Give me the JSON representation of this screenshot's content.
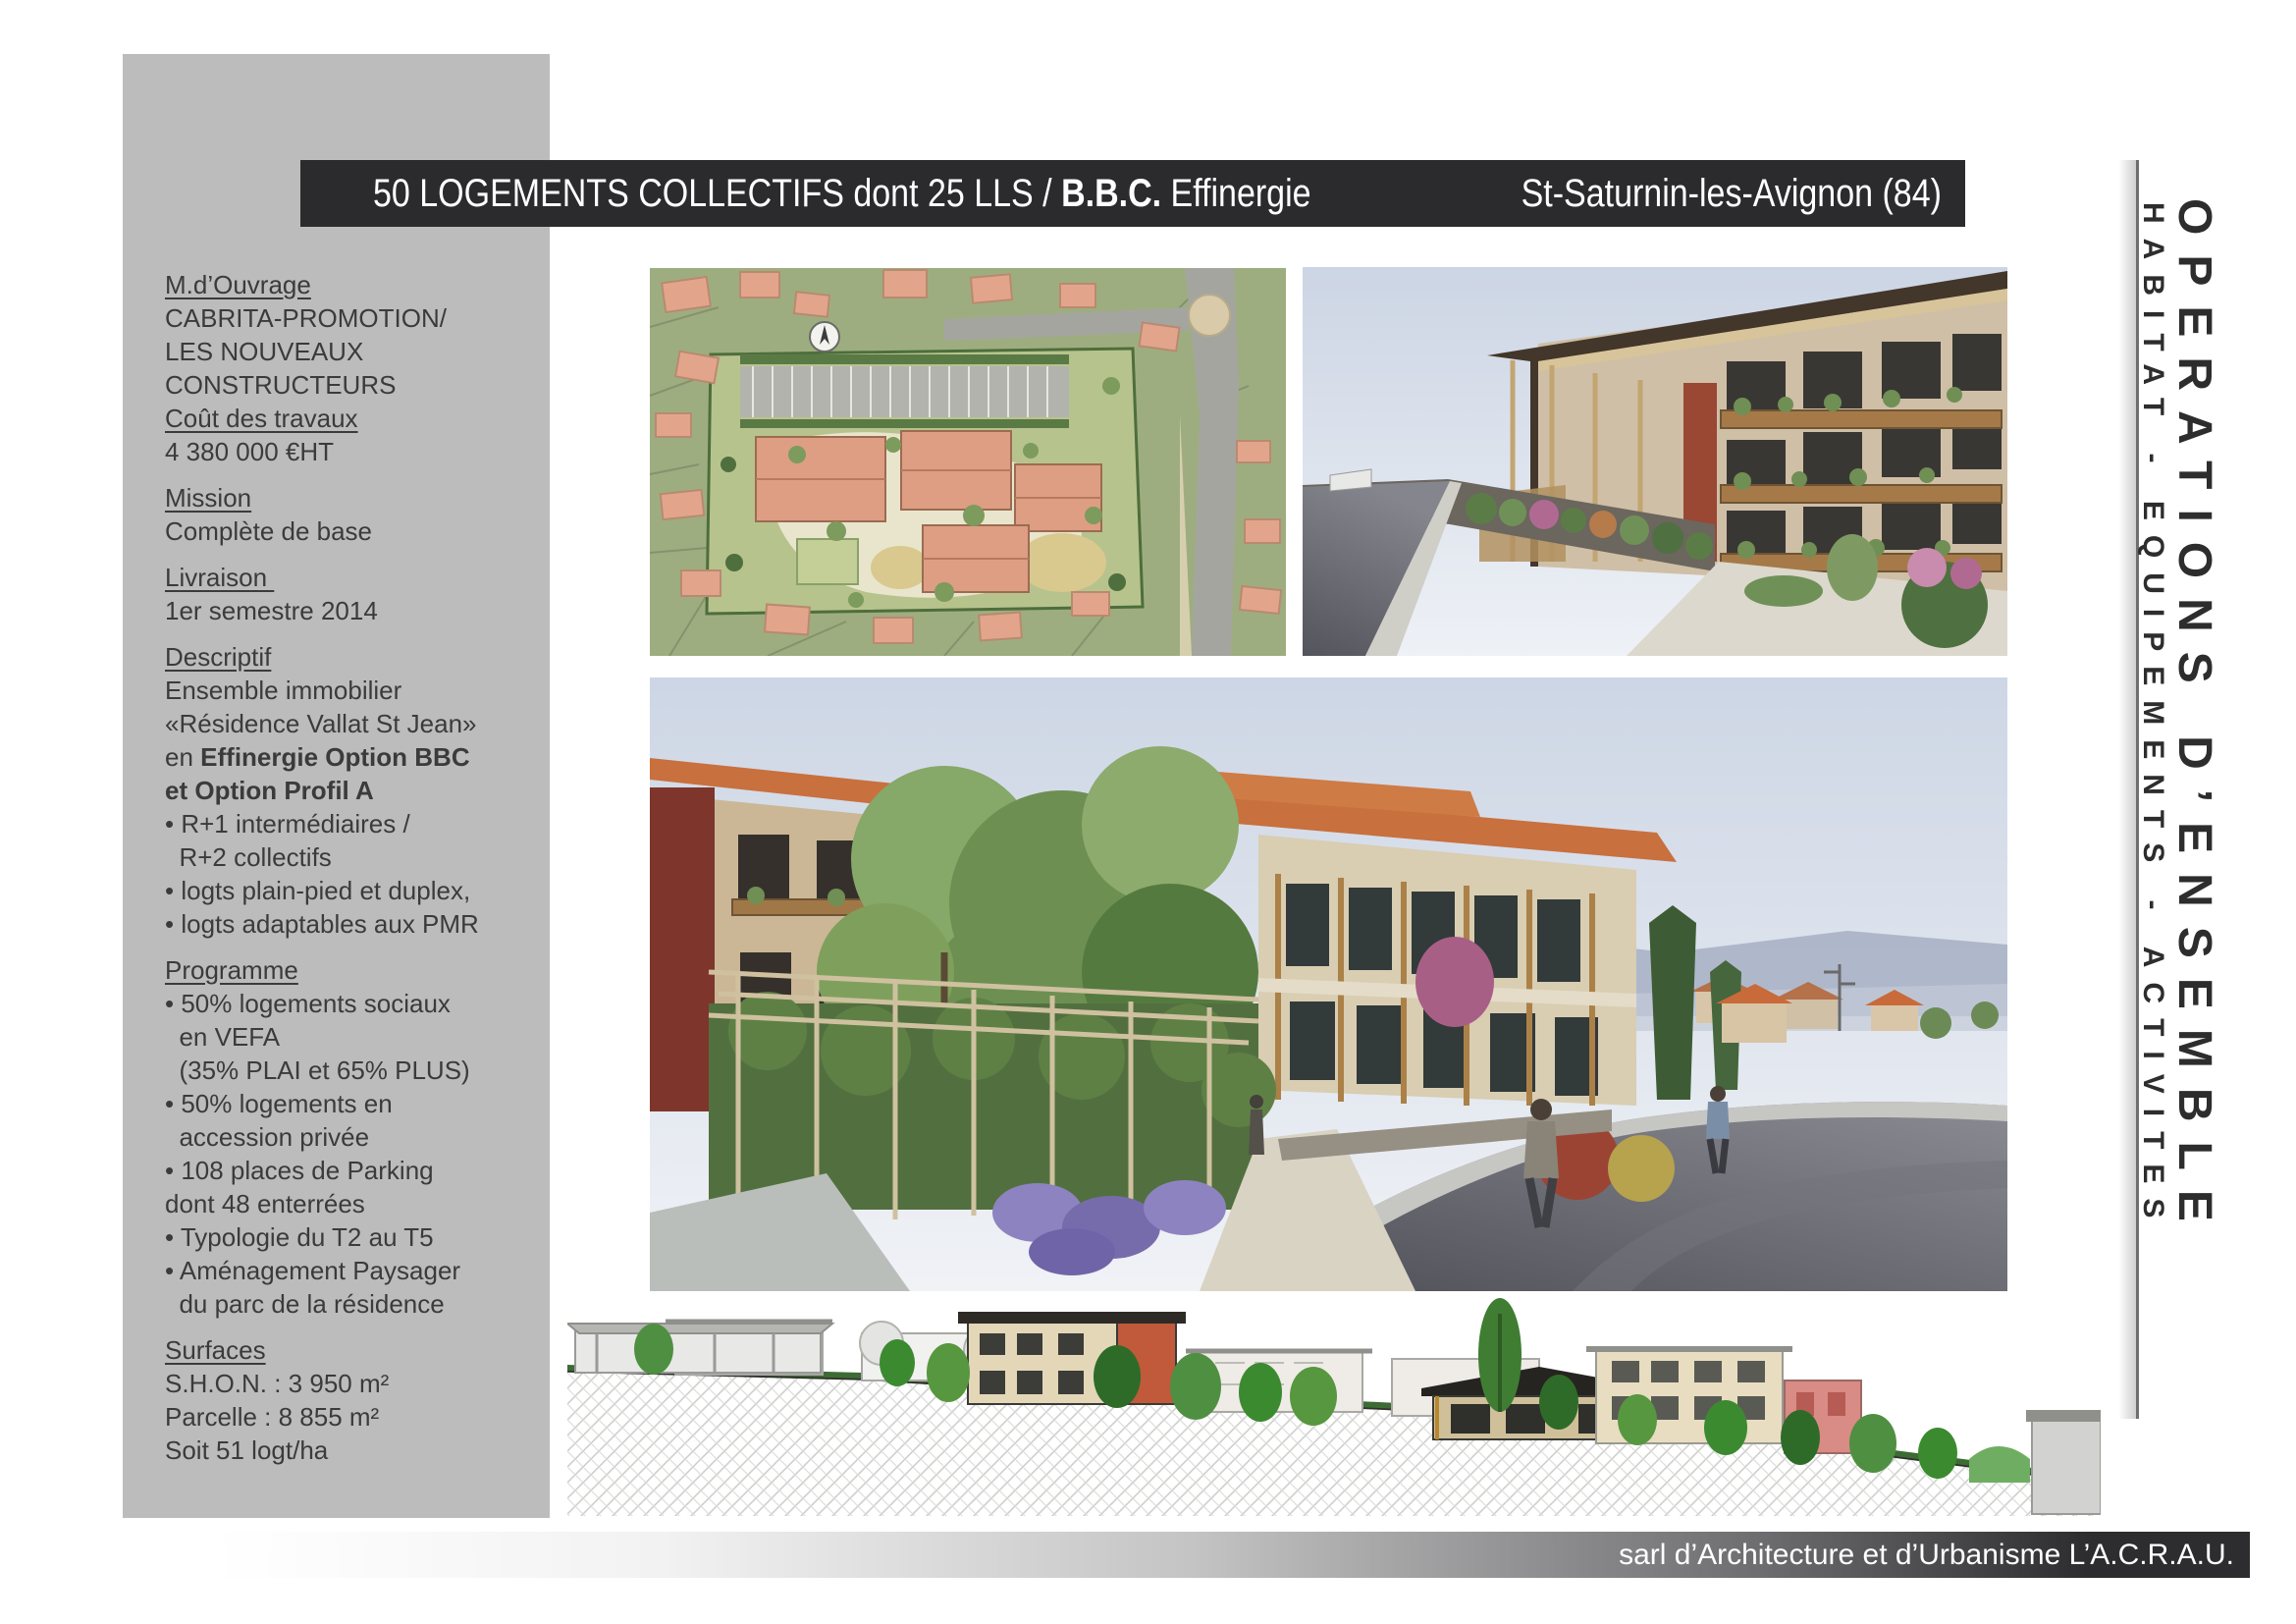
{
  "title_bar": {
    "left_regular": "50 LOGEMENTS COLLECTIFS dont 25 LLS / ",
    "bold": "B.B.C.",
    "after_bold": " Effinergie",
    "location": "St-Saturnin-les-Avignon (84)",
    "bg_color": "#2b2b2d",
    "text_color": "#ffffff"
  },
  "sidebar": {
    "bg_color": "#bcbcbc",
    "text_color": "#3b3b3b",
    "blocks": [
      {
        "lines": [
          {
            "u": true,
            "parts": [
              [
                "M.d’Ouvrage",
                false
              ]
            ]
          },
          {
            "parts": [
              [
                "CABRITA-PROMOTION/",
                false
              ]
            ]
          },
          {
            "parts": [
              [
                "LES NOUVEAUX",
                false
              ]
            ]
          },
          {
            "parts": [
              [
                "CONSTRUCTEURS",
                false
              ]
            ]
          },
          {
            "u": true,
            "parts": [
              [
                "Coût des travaux",
                false
              ]
            ]
          },
          {
            "parts": [
              [
                "4 380 000 €HT",
                false
              ]
            ]
          }
        ]
      },
      {
        "lines": [
          {
            "u": true,
            "parts": [
              [
                "Mission",
                false
              ]
            ]
          },
          {
            "parts": [
              [
                "Complète de base",
                false
              ]
            ]
          }
        ]
      },
      {
        "lines": [
          {
            "u": true,
            "parts": [
              [
                "Livraison ",
                false
              ]
            ]
          },
          {
            "parts": [
              [
                "1er semestre 2014",
                false
              ]
            ]
          }
        ]
      },
      {
        "lines": [
          {
            "u": true,
            "parts": [
              [
                "Descriptif",
                false
              ]
            ]
          },
          {
            "parts": [
              [
                "Ensemble immobilier",
                false
              ]
            ]
          },
          {
            "parts": [
              [
                "«Résidence Vallat St Jean»",
                false
              ]
            ]
          },
          {
            "parts": [
              [
                "en ",
                false
              ],
              [
                "Effinergie Option BBC",
                true
              ]
            ]
          },
          {
            "parts": [
              [
                "et Option Profil A",
                true
              ]
            ]
          },
          {
            "parts": [
              [
                "• R+1 intermédiaires /",
                false
              ]
            ]
          },
          {
            "parts": [
              [
                "  R+2 collectifs",
                false
              ]
            ]
          },
          {
            "parts": [
              [
                "• logts plain-pied et duplex,",
                false
              ]
            ]
          },
          {
            "parts": [
              [
                "• logts adaptables aux PMR",
                false
              ]
            ]
          }
        ]
      },
      {
        "lines": [
          {
            "u": true,
            "parts": [
              [
                "Programme",
                false
              ]
            ]
          },
          {
            "parts": [
              [
                "• 50% logements sociaux",
                false
              ]
            ]
          },
          {
            "parts": [
              [
                "  en VEFA",
                false
              ]
            ]
          },
          {
            "parts": [
              [
                "  (35% PLAI et 65% PLUS)",
                false
              ]
            ]
          },
          {
            "parts": [
              [
                "• 50% logements en",
                false
              ]
            ]
          },
          {
            "parts": [
              [
                "  accession privée",
                false
              ]
            ]
          },
          {
            "parts": [
              [
                "• 108 places de Parking",
                false
              ]
            ]
          },
          {
            "parts": [
              [
                "dont 48 enterrées",
                false
              ]
            ]
          },
          {
            "parts": [
              [
                "• Typologie du T2 au T5",
                false
              ]
            ]
          },
          {
            "parts": [
              [
                "• Aménagement Paysager",
                false
              ]
            ]
          },
          {
            "parts": [
              [
                "  du parc de la résidence",
                false
              ]
            ]
          }
        ]
      },
      {
        "lines": [
          {
            "u": true,
            "parts": [
              [
                "Surfaces",
                false
              ]
            ]
          },
          {
            "parts": [
              [
                "S.H.O.N. : 3 950 m²",
                false
              ]
            ]
          },
          {
            "parts": [
              [
                "Parcelle : 8 855 m²",
                false
              ]
            ]
          },
          {
            "parts": [
              [
                "Soit 51 logt/ha",
                false
              ]
            ]
          }
        ]
      }
    ]
  },
  "vertical_banner": {
    "primary": "OPERATIONS D’ENSEMBLE",
    "secondary": "HABITAT - EQUIPEMENTS - ACTIVITES",
    "text_color": "#2d2d2d"
  },
  "footer": {
    "credit": "sarl d’Architecture et d’Urbanisme L’A.C.R.A.U.",
    "bar_dark_color": "#2d2d2f"
  },
  "palette": {
    "site_plan_green": "#9ead7f",
    "roof_salmon": "#e2a58c",
    "render_sky": "#d5dce9",
    "render_roof_orange": "#c8703e",
    "render_wood": "#a57a48",
    "road_gray": "#5e5e66"
  }
}
